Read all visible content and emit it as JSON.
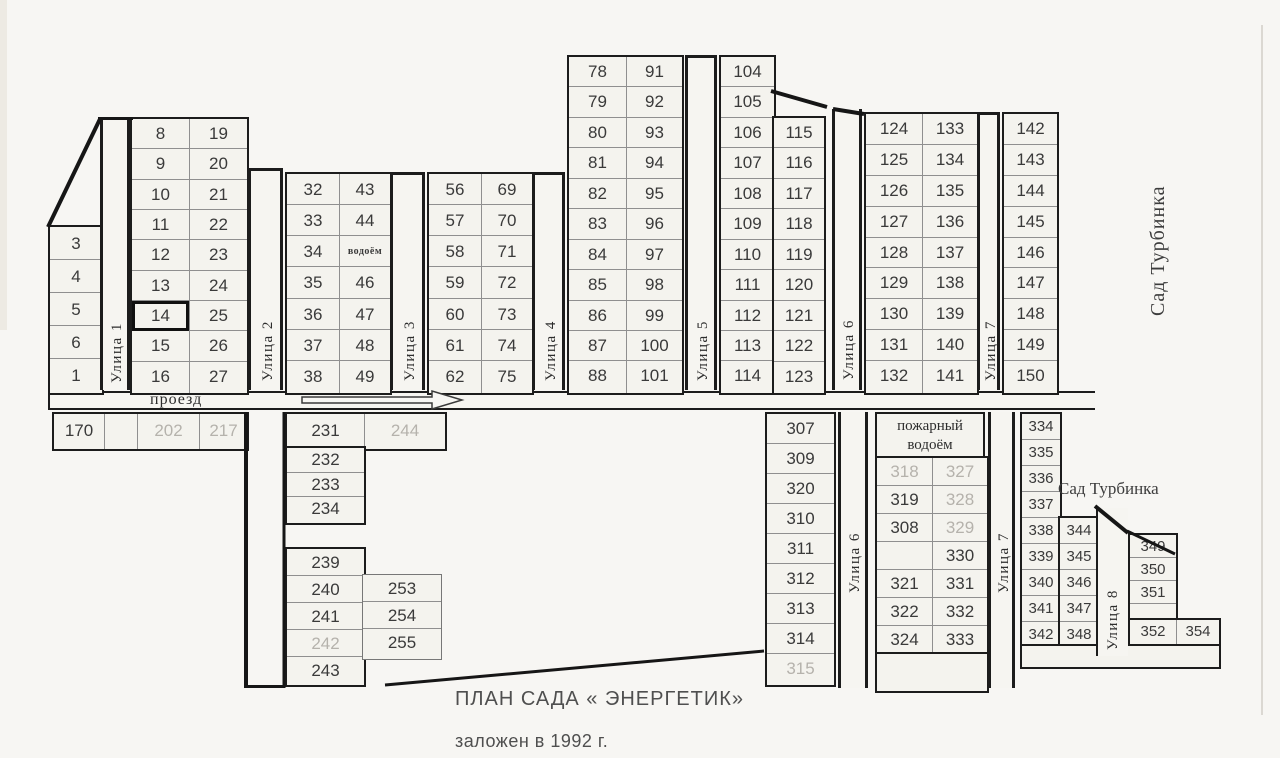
{
  "title": {
    "main": "ПЛАН САДА « ЭНЕРГЕТИК»",
    "sub": "заложен в 1992 г."
  },
  "road": {
    "label": "проезд"
  },
  "regions": {
    "right_vertical": "Сад Турбинка",
    "bottom_horizontal": "Сад Турбинка"
  },
  "colors": {
    "paper": "#f7f6f3",
    "ink": "#1c1c1c",
    "faded_number": "#b5b2ac",
    "number": "#3a3a3a"
  },
  "fire_header": {
    "x": 875,
    "y": 412,
    "w": 110,
    "h": 46,
    "lines": [
      "пожарный",
      "водоём"
    ]
  },
  "streets": [
    {
      "name": "street-1",
      "label": "Улица 1",
      "x": 100,
      "y": 117,
      "w": 30,
      "h": 273,
      "cap": true,
      "lb": 10
    },
    {
      "name": "street-2",
      "label": "Улица 2",
      "x": 248,
      "y": 168,
      "w": 35,
      "h": 222,
      "cap": true,
      "lb": 12
    },
    {
      "name": "street-3",
      "label": "Улица 3",
      "x": 390,
      "y": 172,
      "w": 35,
      "h": 218,
      "cap": true,
      "lb": 12
    },
    {
      "name": "street-4",
      "label": "Улица 4",
      "x": 532,
      "y": 172,
      "w": 33,
      "h": 218,
      "cap": true,
      "lb": 12
    },
    {
      "name": "street-5",
      "label": "Улица 5",
      "x": 685,
      "y": 55,
      "w": 32,
      "h": 335,
      "cap": true,
      "lb": 12
    },
    {
      "name": "street-6-upper",
      "label": "Улица 6",
      "x": 832,
      "y": 109,
      "w": 30,
      "h": 281,
      "cap": false,
      "lb": 10
    },
    {
      "name": "street-7-upper",
      "label": "Улица 7",
      "x": 977,
      "y": 112,
      "w": 23,
      "h": 278,
      "cap": true,
      "lb": 12
    },
    {
      "name": "street-6-lower",
      "label": "Улица 6",
      "x": 838,
      "y": 412,
      "w": 30,
      "h": 276,
      "cap": false,
      "lb": 95
    },
    {
      "name": "street-7-lower",
      "label": "Улица 7",
      "x": 988,
      "y": 412,
      "w": 27,
      "h": 276,
      "cap": false,
      "lb": 95
    },
    {
      "name": "street-8",
      "label": "Улица 8",
      "x": 1096,
      "y": 508,
      "w": 32,
      "h": 148,
      "cap": false,
      "lb": 6,
      "left_only": true
    }
  ],
  "blocks": [
    {
      "name": "plots-3-1",
      "x": 48,
      "y": 225,
      "ch": 33,
      "cols": [
        {
          "w": 52,
          "cells": [
            "3",
            "4",
            "5",
            "6",
            "1"
          ]
        }
      ]
    },
    {
      "name": "plots-8-27",
      "x": 130,
      "y": 117,
      "ch": 30.33,
      "cols": [
        {
          "w": 57,
          "cells": [
            "8",
            "9",
            "10",
            "11",
            "12",
            "13",
            {
              "t": "14",
              "hl": 1
            },
            "15",
            "16"
          ]
        },
        {
          "w": 58,
          "cells": [
            "19",
            "20",
            "21",
            "22",
            "23",
            "24",
            "25",
            "26",
            "27"
          ]
        }
      ]
    },
    {
      "name": "plots-32-49",
      "x": 285,
      "y": 172,
      "ch": 31.14,
      "cols": [
        {
          "w": 52,
          "cells": [
            "32",
            "33",
            "34",
            "35",
            "36",
            "37",
            "38"
          ]
        },
        {
          "w": 51,
          "cells": [
            "43",
            "44",
            {
              "t": "водоём",
              "s": 1
            },
            "46",
            "47",
            "48",
            "49"
          ]
        }
      ]
    },
    {
      "name": "plots-56-75",
      "x": 427,
      "y": 172,
      "ch": 31.14,
      "cols": [
        {
          "w": 52,
          "cells": [
            "56",
            "57",
            "58",
            "59",
            "60",
            "61",
            "62"
          ]
        },
        {
          "w": 51,
          "cells": [
            "69",
            "70",
            "71",
            "72",
            "73",
            "74",
            "75"
          ]
        }
      ]
    },
    {
      "name": "plots-78-101",
      "x": 567,
      "y": 55,
      "ch": 30.45,
      "cols": [
        {
          "w": 57,
          "cells": [
            "78",
            "79",
            "80",
            "81",
            "82",
            "83",
            "84",
            "85",
            "86",
            "87",
            "88"
          ]
        },
        {
          "w": 56,
          "cells": [
            "91",
            "92",
            "93",
            "94",
            "95",
            "96",
            "97",
            "98",
            "99",
            "100",
            "101"
          ]
        }
      ]
    },
    {
      "name": "plots-104-114",
      "x": 719,
      "y": 55,
      "ch": 30.45,
      "cols": [
        {
          "w": 53,
          "cells": [
            "104",
            "105",
            "106",
            "107",
            "108",
            "109",
            "110",
            "111",
            "112",
            "113",
            "114"
          ]
        }
      ]
    },
    {
      "name": "plots-115-123",
      "x": 772,
      "y": 116,
      "ch": 30.44,
      "cols": [
        {
          "w": 50,
          "cells": [
            "115",
            "116",
            "117",
            "118",
            "119",
            "120",
            "121",
            "122",
            "123"
          ]
        }
      ]
    },
    {
      "name": "plots-124-141",
      "x": 864,
      "y": 112,
      "ch": 30.9,
      "cols": [
        {
          "w": 56,
          "cells": [
            "124",
            "125",
            "126",
            "127",
            "128",
            "129",
            "130",
            "131",
            "132"
          ]
        },
        {
          "w": 55,
          "cells": [
            "133",
            "134",
            "135",
            "136",
            "137",
            "138",
            "139",
            "140",
            "141"
          ]
        }
      ]
    },
    {
      "name": "plots-142-150",
      "x": 1002,
      "y": 112,
      "ch": 30.9,
      "cols": [
        {
          "w": 53,
          "cells": [
            "142",
            "143",
            "144",
            "145",
            "146",
            "147",
            "148",
            "149",
            "150"
          ]
        }
      ]
    },
    {
      "name": "row-170-217",
      "x": 52,
      "y": 412,
      "ch": 34,
      "cols": [
        {
          "w": 50,
          "cells": [
            "170"
          ]
        },
        {
          "w": 33,
          "cells": [
            ""
          ]
        },
        {
          "w": 62,
          "cells": [
            {
              "t": "202",
              "f": 1
            }
          ]
        },
        {
          "w": 48,
          "cells": [
            {
              "t": "217",
              "f": 1
            }
          ]
        }
      ]
    },
    {
      "name": "row-231-244",
      "x": 285,
      "y": 412,
      "ch": 34,
      "cols": [
        {
          "w": 77,
          "cells": [
            "231"
          ]
        },
        {
          "w": 81,
          "cells": [
            {
              "t": "244",
              "f": 1
            }
          ]
        }
      ]
    },
    {
      "name": "plots-232-234",
      "x": 285,
      "y": 446,
      "ch": 24.7,
      "cols": [
        {
          "w": 77,
          "cells": [
            "232",
            "233",
            "234"
          ]
        }
      ]
    },
    {
      "name": "plots-239-243",
      "x": 285,
      "y": 547,
      "ch": 27,
      "cols": [
        {
          "w": 77,
          "cells": [
            "239",
            "240",
            "241",
            {
              "t": "242",
              "f": 1
            },
            "243"
          ]
        }
      ]
    },
    {
      "name": "plots-253-255",
      "x": 362,
      "y": 574,
      "ch": 27,
      "thin": 1,
      "cols": [
        {
          "w": 78,
          "cells": [
            "253",
            "254",
            "255"
          ]
        }
      ]
    },
    {
      "name": "plots-307-315",
      "x": 765,
      "y": 412,
      "ch": 30,
      "cols": [
        {
          "w": 67,
          "cells": [
            "307",
            "309",
            "320",
            "310",
            "311",
            "312",
            "313",
            "314",
            {
              "t": "315",
              "f": 1
            }
          ]
        }
      ]
    },
    {
      "name": "plots-fire-pond-grid",
      "x": 875,
      "y": 456,
      "ch": 28,
      "cols": [
        {
          "w": 55,
          "cells": [
            {
              "t": "318",
              "f": 1
            },
            "319",
            "308",
            "",
            "321",
            "322",
            "324"
          ]
        },
        {
          "w": 55,
          "cells": [
            {
              "t": "327",
              "f": 1
            },
            {
              "t": "328",
              "f": 1
            },
            {
              "t": "329",
              "f": 1
            },
            "330",
            "331",
            "332",
            "333"
          ]
        }
      ]
    },
    {
      "name": "fire-pond-footer",
      "x": 875,
      "y": 652,
      "ch": 36,
      "cols": [
        {
          "w": 110,
          "cells": [
            ""
          ]
        }
      ]
    },
    {
      "name": "plots-334-342",
      "x": 1020,
      "y": 412,
      "ch": 26,
      "fs": 15,
      "cols": [
        {
          "w": 38,
          "cells": [
            "334",
            "335",
            "336",
            "337",
            "338",
            "339",
            "340",
            "341",
            "342"
          ]
        }
      ]
    },
    {
      "name": "plots-344-348",
      "x": 1058,
      "y": 516,
      "ch": 26,
      "fs": 15,
      "cols": [
        {
          "w": 38,
          "cells": [
            "344",
            "345",
            "346",
            "347",
            "348"
          ]
        }
      ]
    },
    {
      "name": "plots-349-351",
      "x": 1128,
      "y": 533,
      "ch": 23,
      "fs": 15,
      "cols": [
        {
          "w": 46,
          "cells": [
            "349",
            "350",
            "351",
            {
              "t": "",
              "h": 16
            }
          ]
        }
      ]
    },
    {
      "name": "row-352-354",
      "x": 1128,
      "y": 618,
      "ch": 23,
      "fs": 15,
      "cols": [
        {
          "w": 46,
          "cells": [
            "352"
          ]
        },
        {
          "w": 43,
          "cells": [
            "354"
          ]
        }
      ]
    },
    {
      "name": "strip-bottom-right",
      "x": 1020,
      "y": 644,
      "ch": 20,
      "cols": [
        {
          "w": 197,
          "cells": [
            ""
          ]
        }
      ]
    }
  ]
}
